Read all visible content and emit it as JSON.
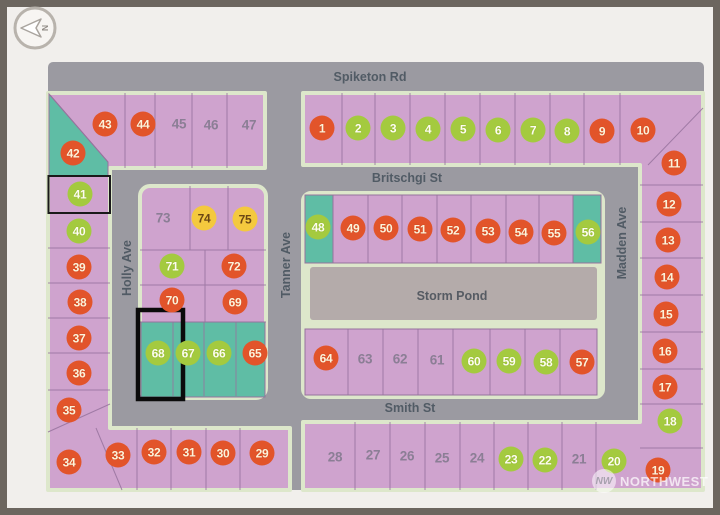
{
  "compass": {
    "label": "N"
  },
  "streets": {
    "spiketon_rd": "Spiketon Rd",
    "britschgi_st": "Britschgi St",
    "smith_st": "Smith St",
    "holly_ave": "Holly Ave",
    "tanner_ave": "Tanner Ave",
    "madden_ave": "Madden Ave"
  },
  "pond": {
    "label": "Storm Pond"
  },
  "watermark": {
    "logo": "NW",
    "text": "NORTHWEST"
  },
  "highlight": {
    "lot": "68"
  },
  "outlined_lot": "41",
  "colors": {
    "red_marker": "#e2542a",
    "green_marker": "#a4ca3f",
    "yellow_marker": "#f4c93e",
    "plain_number_text": "#8b7e95",
    "parcel_pink": "#cfa3ce",
    "parcel_teal": "#5fbda5",
    "road_gray": "#9b9aa1",
    "block_border_green": "#dde7cb",
    "pond_gray": "#b4abaa"
  },
  "lots": [
    {
      "num": "1",
      "status": "red",
      "x": 322,
      "y": 128
    },
    {
      "num": "2",
      "status": "green",
      "x": 358,
      "y": 128
    },
    {
      "num": "3",
      "status": "green",
      "x": 393,
      "y": 128
    },
    {
      "num": "4",
      "status": "green",
      "x": 428,
      "y": 129
    },
    {
      "num": "5",
      "status": "green",
      "x": 463,
      "y": 129
    },
    {
      "num": "6",
      "status": "green",
      "x": 498,
      "y": 130
    },
    {
      "num": "7",
      "status": "green",
      "x": 533,
      "y": 130
    },
    {
      "num": "8",
      "status": "green",
      "x": 567,
      "y": 131
    },
    {
      "num": "9",
      "status": "red",
      "x": 602,
      "y": 131
    },
    {
      "num": "10",
      "status": "red",
      "x": 643,
      "y": 130
    },
    {
      "num": "11",
      "status": "red",
      "x": 674,
      "y": 163
    },
    {
      "num": "12",
      "status": "red",
      "x": 669,
      "y": 204
    },
    {
      "num": "13",
      "status": "red",
      "x": 668,
      "y": 240
    },
    {
      "num": "14",
      "status": "red",
      "x": 667,
      "y": 277
    },
    {
      "num": "15",
      "status": "red",
      "x": 666,
      "y": 314
    },
    {
      "num": "16",
      "status": "red",
      "x": 665,
      "y": 351
    },
    {
      "num": "17",
      "status": "red",
      "x": 665,
      "y": 387
    },
    {
      "num": "18",
      "status": "green",
      "x": 670,
      "y": 421
    },
    {
      "num": "19",
      "status": "red",
      "x": 658,
      "y": 470
    },
    {
      "num": "20",
      "status": "green",
      "x": 614,
      "y": 461
    },
    {
      "num": "21",
      "status": "plain",
      "x": 579,
      "y": 459
    },
    {
      "num": "22",
      "status": "green",
      "x": 545,
      "y": 460
    },
    {
      "num": "23",
      "status": "green",
      "x": 511,
      "y": 459
    },
    {
      "num": "24",
      "status": "plain",
      "x": 477,
      "y": 458
    },
    {
      "num": "25",
      "status": "plain",
      "x": 442,
      "y": 458
    },
    {
      "num": "26",
      "status": "plain",
      "x": 407,
      "y": 456
    },
    {
      "num": "27",
      "status": "plain",
      "x": 373,
      "y": 455
    },
    {
      "num": "28",
      "status": "plain",
      "x": 335,
      "y": 457
    },
    {
      "num": "29",
      "status": "red",
      "x": 262,
      "y": 453
    },
    {
      "num": "30",
      "status": "red",
      "x": 223,
      "y": 453
    },
    {
      "num": "31",
      "status": "red",
      "x": 189,
      "y": 452
    },
    {
      "num": "32",
      "status": "red",
      "x": 154,
      "y": 452
    },
    {
      "num": "33",
      "status": "red",
      "x": 118,
      "y": 455
    },
    {
      "num": "34",
      "status": "red",
      "x": 69,
      "y": 462
    },
    {
      "num": "35",
      "status": "red",
      "x": 69,
      "y": 410
    },
    {
      "num": "36",
      "status": "red",
      "x": 79,
      "y": 373
    },
    {
      "num": "37",
      "status": "red",
      "x": 79,
      "y": 338
    },
    {
      "num": "38",
      "status": "red",
      "x": 80,
      "y": 302
    },
    {
      "num": "39",
      "status": "red",
      "x": 79,
      "y": 267
    },
    {
      "num": "40",
      "status": "green",
      "x": 79,
      "y": 231
    },
    {
      "num": "41",
      "status": "green",
      "x": 80,
      "y": 194
    },
    {
      "num": "42",
      "status": "red",
      "x": 73,
      "y": 153
    },
    {
      "num": "43",
      "status": "red",
      "x": 105,
      "y": 124
    },
    {
      "num": "44",
      "status": "red",
      "x": 143,
      "y": 124
    },
    {
      "num": "45",
      "status": "plain",
      "x": 179,
      "y": 124
    },
    {
      "num": "46",
      "status": "plain",
      "x": 211,
      "y": 125
    },
    {
      "num": "47",
      "status": "plain",
      "x": 249,
      "y": 125
    },
    {
      "num": "48",
      "status": "green",
      "x": 318,
      "y": 227
    },
    {
      "num": "49",
      "status": "red",
      "x": 353,
      "y": 228
    },
    {
      "num": "50",
      "status": "red",
      "x": 386,
      "y": 228
    },
    {
      "num": "51",
      "status": "red",
      "x": 420,
      "y": 229
    },
    {
      "num": "52",
      "status": "red",
      "x": 453,
      "y": 230
    },
    {
      "num": "53",
      "status": "red",
      "x": 488,
      "y": 231
    },
    {
      "num": "54",
      "status": "red",
      "x": 521,
      "y": 232
    },
    {
      "num": "55",
      "status": "red",
      "x": 554,
      "y": 233
    },
    {
      "num": "56",
      "status": "green",
      "x": 588,
      "y": 232
    },
    {
      "num": "57",
      "status": "red",
      "x": 582,
      "y": 362
    },
    {
      "num": "58",
      "status": "green",
      "x": 546,
      "y": 362
    },
    {
      "num": "59",
      "status": "green",
      "x": 509,
      "y": 361
    },
    {
      "num": "60",
      "status": "green",
      "x": 474,
      "y": 361
    },
    {
      "num": "61",
      "status": "plain",
      "x": 437,
      "y": 360
    },
    {
      "num": "62",
      "status": "plain",
      "x": 400,
      "y": 359
    },
    {
      "num": "63",
      "status": "plain",
      "x": 365,
      "y": 359
    },
    {
      "num": "64",
      "status": "red",
      "x": 326,
      "y": 358
    },
    {
      "num": "65",
      "status": "red",
      "x": 255,
      "y": 353
    },
    {
      "num": "66",
      "status": "green",
      "x": 219,
      "y": 353
    },
    {
      "num": "67",
      "status": "green",
      "x": 188,
      "y": 353
    },
    {
      "num": "68",
      "status": "green",
      "x": 158,
      "y": 353
    },
    {
      "num": "69",
      "status": "red",
      "x": 235,
      "y": 302
    },
    {
      "num": "70",
      "status": "red",
      "x": 172,
      "y": 300
    },
    {
      "num": "71",
      "status": "green",
      "x": 172,
      "y": 266
    },
    {
      "num": "72",
      "status": "red",
      "x": 234,
      "y": 266
    },
    {
      "num": "73",
      "status": "plain",
      "x": 163,
      "y": 218
    },
    {
      "num": "74",
      "status": "yellow",
      "x": 204,
      "y": 218
    },
    {
      "num": "75",
      "status": "yellow",
      "x": 245,
      "y": 219
    }
  ]
}
